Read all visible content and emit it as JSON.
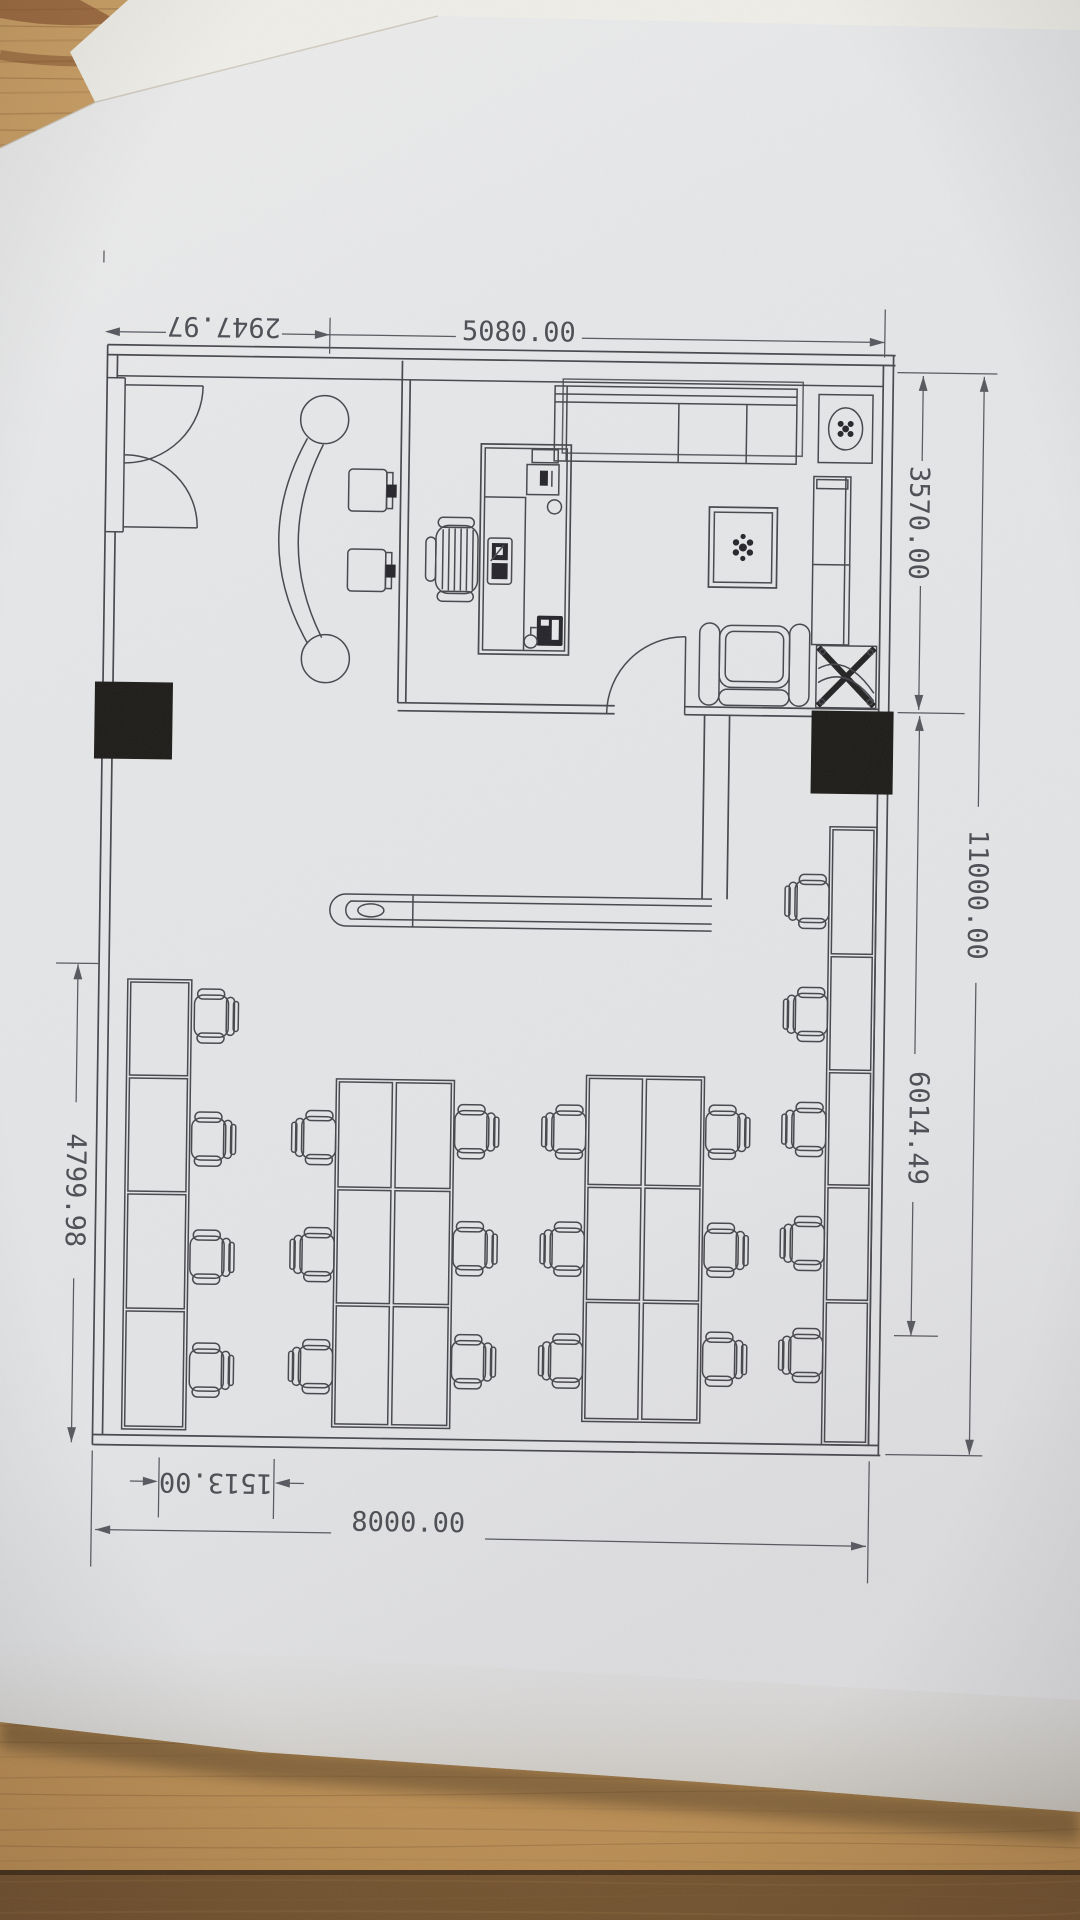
{
  "scene": {
    "description": "Photograph of a printed CAD office floor plan lying on a wooden desk",
    "paper_color": "#e7e8ea",
    "line_color": "#45454c",
    "wood_color": "#c59a60",
    "wood_dark": "#7d5b37",
    "column_fill": "#1d1b18"
  },
  "dimensions": {
    "top_left": "2947.97",
    "top_right": "5080.00",
    "right_upper": "3570.00",
    "right_outer": "11000.00",
    "right_lower": "6014.49",
    "left": "4799.98",
    "bottom_inner": "1513.00",
    "bottom_outer": "8000.00"
  },
  "plan": {
    "areas": [
      "reception",
      "private-office",
      "open-office"
    ],
    "furniture": {
      "reception": [
        "double-entry-door",
        "curved-reception-desk",
        "visitor-chair x2",
        "bar-counter"
      ],
      "private_office": [
        "executive-desk",
        "monitor-keyboard",
        "desktop-pc",
        "telephone",
        "executive-chair",
        "sofa",
        "coffee-table-with-plant",
        "armchair-with-ottoman",
        "tv-cabinet",
        "potted-plant",
        "hatched-ac-unit",
        "office-door"
      ],
      "open_office": [
        "left-desk-bay x4",
        "desk-cluster-2x3 x2",
        "right-desk-bay x5",
        "office-chair x21",
        "structural-column x2"
      ]
    }
  }
}
